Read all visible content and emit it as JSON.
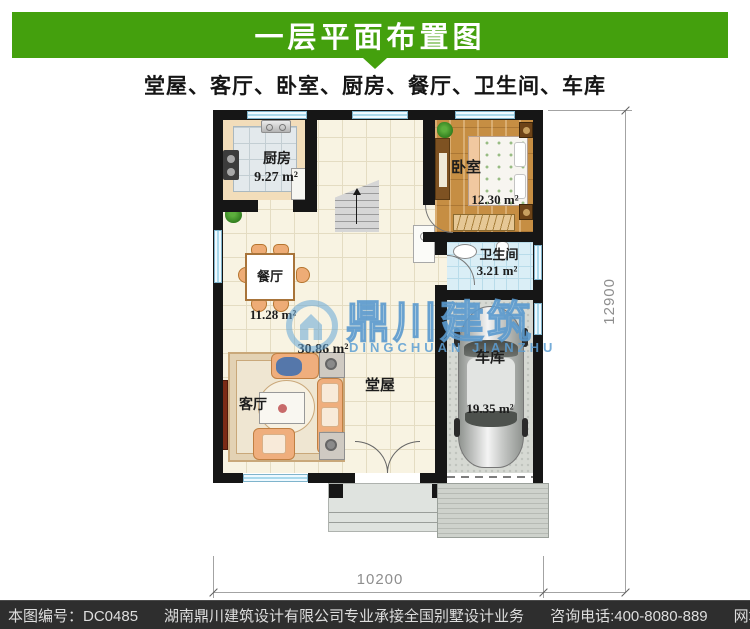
{
  "colors": {
    "accent_green": "#44a00d",
    "watermark_blue": "#5c9fd0",
    "footer_bg": "#2e2e2e"
  },
  "header": {
    "title": "一层平面布置图"
  },
  "subtitle": "堂屋、客厅、卧室、厨房、餐厅、卫生间、车库",
  "plan": {
    "rooms": {
      "kitchen": {
        "name": "厨房",
        "area": "9.27 m²"
      },
      "bedroom": {
        "name": "卧室",
        "area": "12.30 m²"
      },
      "bathroom": {
        "name": "卫生间",
        "area": "3.21 m²"
      },
      "dining": {
        "name": "餐厅",
        "area": "11.28 m²"
      },
      "hall": {
        "name": "堂屋",
        "area": "30.86 m²"
      },
      "living": {
        "name": "客厅"
      },
      "garage": {
        "name": "车库",
        "area": "19.35 m²"
      }
    },
    "dimensions": {
      "width_mm": "10200",
      "height_mm": "12900"
    }
  },
  "watermark": {
    "cn": "鼎川建筑",
    "en": "DINGCHUAN JIANZHU"
  },
  "footer": {
    "drawing_no": "本图编号：DC0485",
    "company": "湖南鼎川建筑设计有限公司专业承接全国别墅设计业务",
    "phone": "咨询电话:400-8080-889",
    "website": "网址：www.bstzcs.com"
  }
}
